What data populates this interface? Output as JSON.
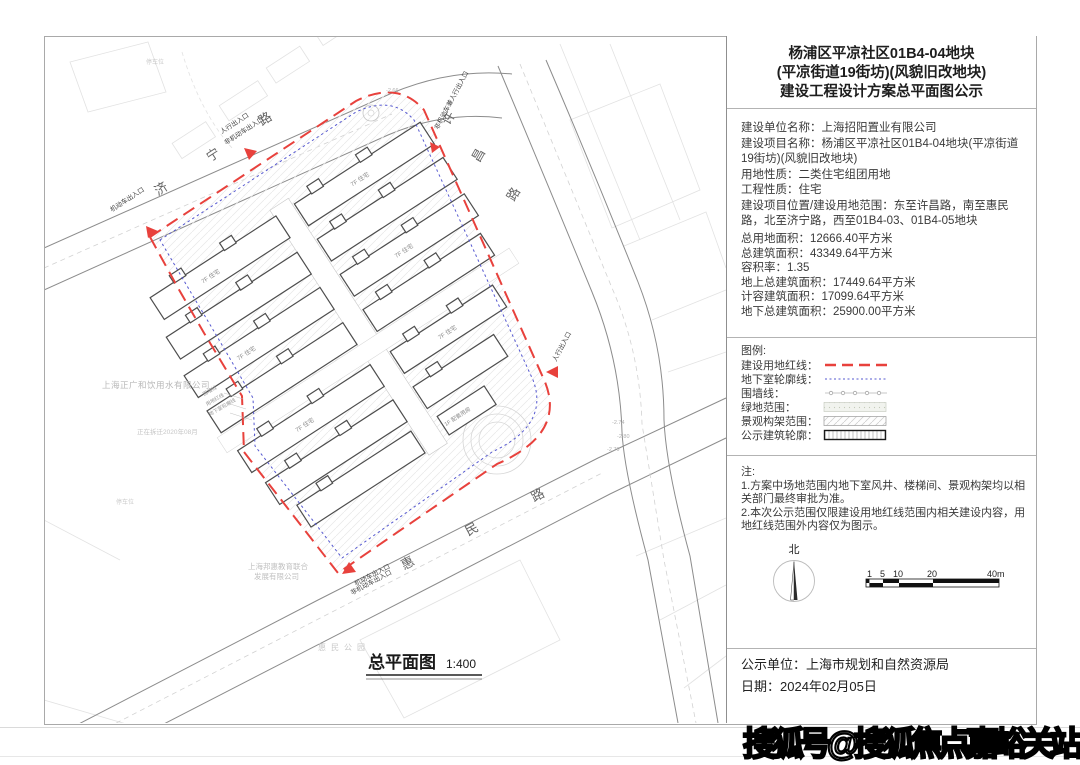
{
  "panel": {
    "title_lines": [
      "杨浦区平凉社区01B4-04地块",
      "(平凉街道19街坊)(风貌旧改地块)",
      "建设工程设计方案总平面图公示"
    ],
    "info_lines": [
      "建设单位名称：上海招阳置业有限公司",
      "建设项目名称：杨浦区平凉社区01B4-04地块(平凉街道19街坊)(风貌旧改地块)",
      "用地性质：二类住宅组团用地",
      "工程性质：住宅",
      "建设项目位置/建设用地范围：东至许昌路，南至惠民路，北至济宁路，西至01B4-03、01B4-05地块"
    ],
    "stats_lines": [
      "总用地面积：12666.40平方米",
      "总建筑面积：43349.64平方米",
      "容积率：1.35",
      "地上总建筑面积：17449.64平方米",
      "计容建筑面积：17099.64平方米",
      "地下总建筑面积：25900.00平方米"
    ],
    "legend": {
      "heading": "图例:",
      "items": [
        {
          "label": "建设用地红线："
        },
        {
          "label": "地下室轮廓线："
        },
        {
          "label": "围墙线："
        },
        {
          "label": "绿地范围："
        },
        {
          "label": "景观构架范围："
        },
        {
          "label": "公示建筑轮廓："
        }
      ]
    },
    "notes": {
      "heading": "注:",
      "lines": [
        "1.方案中场地范围内地下室风井、楼梯间、景观构架均以相关部门最终审批为准。",
        "2.本次公示范围仅限建设用地红线范围内相关建设内容，用地红线范围外内容仅为图示。"
      ]
    },
    "north_label": "北",
    "scale_ticks": [
      "1",
      "5",
      "10",
      "20",
      "40m"
    ],
    "footer": {
      "publisher": "公示单位：上海市规划和自然资源局",
      "date": "日期：2024年02月05日"
    }
  },
  "map": {
    "caption": "总平面图",
    "caption_scale": "1:400",
    "roads": [
      {
        "name": "济宁路",
        "chars": [
          "济",
          "宁",
          "路"
        ]
      },
      {
        "name": "许昌路",
        "chars": [
          "许",
          "昌",
          "路"
        ]
      },
      {
        "name": "惠民路",
        "chars": [
          "惠",
          "民",
          "路"
        ]
      }
    ],
    "entrance_labels": {
      "vehicle": "机动车出入口",
      "pedestrian": "人行出入口",
      "nonmotor": "非机动车出入口",
      "nonmotor_ped": "非机动车兼人行出入口"
    },
    "leader_labels": [
      "围墙线",
      "用地红线",
      "地下室轮廓线"
    ],
    "context": {
      "company1": "上海正广和饮用水有限公司",
      "demolition": "正在拆迁2020年08月",
      "company2a": "上海邦惠教育联合",
      "company2b": "发展有限公司",
      "park": "惠民公园",
      "parking": "停车位"
    },
    "building_label": "7F 住宅",
    "service_label": "1F 配套用房",
    "elevations": [
      "-2.66",
      "-2.74",
      "-2.80",
      "-2.79"
    ]
  },
  "watermark": {
    "text": "搜狐号@搜狐焦点嘉峪关站"
  },
  "colors": {
    "red_line": "#e8413c",
    "blue_line": "#5558d0",
    "building_stroke": "#4d4d4d"
  }
}
